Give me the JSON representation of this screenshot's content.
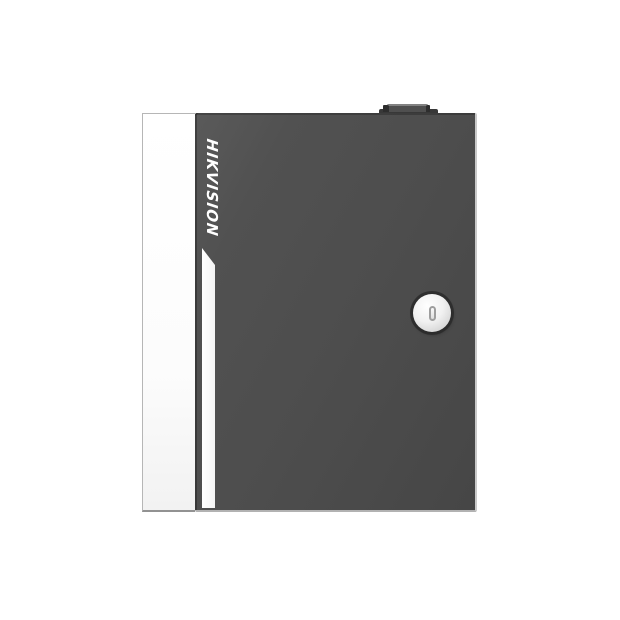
{
  "scene": {
    "type": "product-photo",
    "background_color": "#ffffff",
    "subject": "Wall-mount security enclosure with hinged door, viewed from the front"
  },
  "device": {
    "brand_label": "HIKVISION",
    "brand_text_color": "#ffffff",
    "door_color": "#4d4d4d",
    "door_edge_highlight_color": "#c9c9c9",
    "side_panel_color": "#fdfdfd",
    "accent_stripe_color": "#fafafa",
    "top_tab_color": "#383838",
    "top_tab_highlight_color": "#828282",
    "lock": {
      "face_color": "#ededed",
      "ring_shadow_color": "#2a2a2a",
      "slot_outline_color": "#9e9e9e"
    }
  }
}
